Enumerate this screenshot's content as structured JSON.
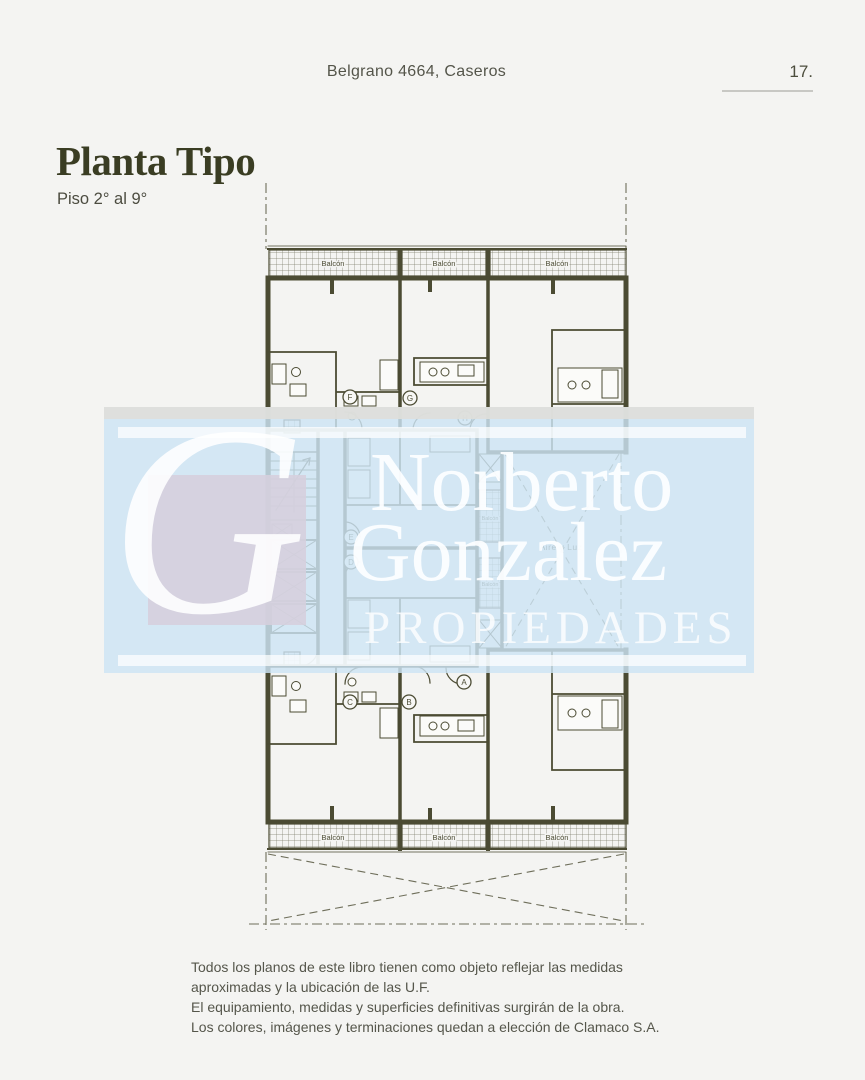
{
  "theme": {
    "bg": "#f4f4f2",
    "plan": "#4b4b33",
    "guide": "#6e6e5a",
    "title": "#3a3d23",
    "text": "#55564b",
    "rule": "#c8c8c4",
    "band": "rgba(205,228,244,0.82)"
  },
  "header": {
    "address": "Belgrano 4664, Caseros",
    "page_number": "17."
  },
  "title": {
    "main": "Planta Tipo",
    "subtitle": "Piso 2° al 9°"
  },
  "floorplan": {
    "balcony_label": "Balcón",
    "courtyard_label": "Aire y Luz",
    "units": [
      "F",
      "G",
      "H",
      "E",
      "D",
      "A",
      "B",
      "C"
    ]
  },
  "watermark": {
    "monogram": "G",
    "name_line1": "Norberto",
    "name_line2": "Gonzalez",
    "tagline": "PROPIEDADES"
  },
  "footer": {
    "lines": [
      "Todos los planos de este libro tienen como objeto reflejar las medidas",
      "aproximadas y la ubicación de las U.F.",
      "El equipamiento, medidas y superficies definitivas surgirán de la obra.",
      "Los colores, imágenes y terminaciones quedan a elección de Clamaco S.A."
    ]
  }
}
